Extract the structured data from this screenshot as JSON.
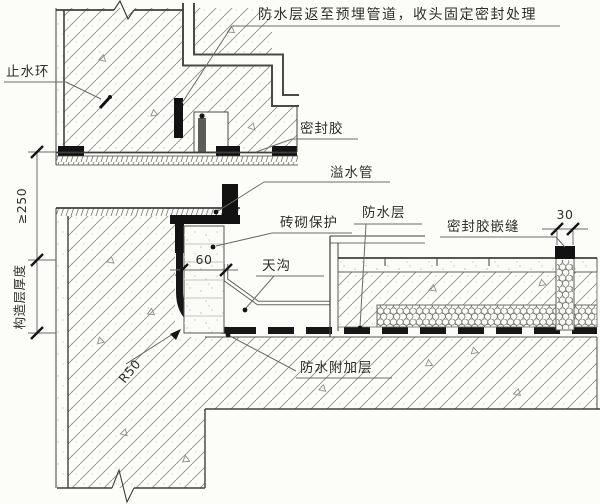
{
  "drawing": {
    "title_note": "防水层返至预埋管道，收头固定密封处理",
    "labels": {
      "water_stop_ring": "止水环",
      "sealant": "密封胶",
      "overflow_pipe": "溢水管",
      "brick_protection": "砖砌保护",
      "waterproof_layer": "防水层",
      "sealant_caulk_joint": "密封胶嵌缝",
      "gutter": "天沟",
      "waterproof_additional_layer": "防水附加层"
    },
    "dimensions": {
      "upturn_min_height": "≥250",
      "construction_layer_thickness": "构造层厚度",
      "protection_wall_width": "60",
      "joint_width": "30",
      "fillet_radius": "R50"
    },
    "colors": {
      "paper": "#fcfcf9",
      "line": "#3f3f3c",
      "membrane_black": "#121212",
      "hatch": "#8e8e88",
      "leader": "#6b6b66",
      "text": "#2e2e2a"
    }
  }
}
